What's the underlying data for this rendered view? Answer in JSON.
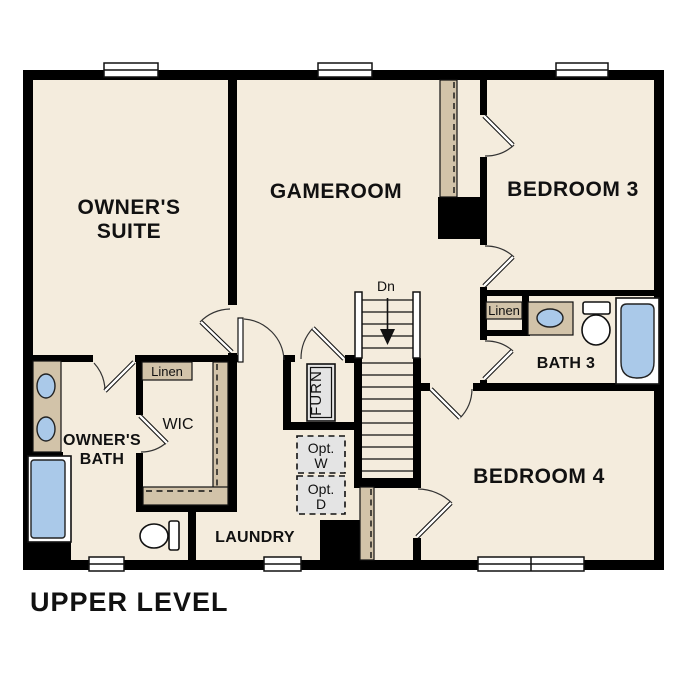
{
  "title": "UPPER LEVEL",
  "colors": {
    "floor": "#f4ecdd",
    "wall": "#000000",
    "shelf_tan": "#d2c3a9",
    "fixture_blue": "#aac9e9",
    "optional_gray": "#e4e4e4"
  },
  "rooms": {
    "owners_suite": {
      "label_line1": "OWNER'S",
      "label_line2": "SUITE"
    },
    "gameroom": {
      "label": "GAMEROOM"
    },
    "bedroom3": {
      "label": "BEDROOM 3"
    },
    "bedroom4": {
      "label": "BEDROOM 4"
    },
    "bath3": {
      "label": "BATH 3"
    },
    "owners_bath": {
      "label_line1": "OWNER'S",
      "label_line2": "BATH"
    },
    "wic": {
      "label": "WIC"
    },
    "laundry": {
      "label": "LAUNDRY"
    },
    "linen_hall": {
      "label": "Linen"
    },
    "linen_bath3": {
      "label": "Linen"
    },
    "furnace_closet": {
      "label": "FURN"
    },
    "stairs": {
      "direction_label": "Dn"
    },
    "optional_washer": {
      "line1": "Opt.",
      "line2": "W"
    },
    "optional_dryer": {
      "line1": "Opt.",
      "line2": "D"
    }
  }
}
